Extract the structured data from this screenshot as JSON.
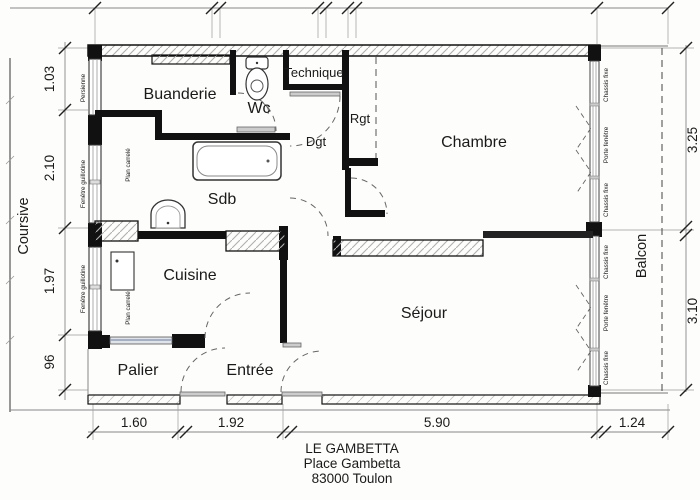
{
  "title_block": {
    "name": "LE GAMBETTA",
    "address": "Place Gambetta",
    "city": "83000 Toulon"
  },
  "rooms": {
    "buanderie": "Buanderie",
    "wc": "Wc",
    "technique": "Technique",
    "rgt": "Rgt",
    "dgt": "Dgt",
    "chambre": "Chambre",
    "sdb": "Sdb",
    "cuisine": "Cuisine",
    "sejour": "Séjour",
    "palier": "Palier",
    "entree": "Entrée"
  },
  "exterior": {
    "coursive": "Coursive",
    "balcon": "Balcon"
  },
  "window_labels": {
    "persienne": "Persienne",
    "guillotine": "Fenêtre guillotine",
    "plan_carrele": "Plan carrelé",
    "chassis_fixe": "Chassis fixe",
    "porte_fenetre": "Porte fenêtre"
  },
  "dimensions": {
    "left": [
      "1.03",
      "2.10",
      "1.97",
      "96"
    ],
    "right": [
      "3.25",
      "3.10"
    ],
    "bottom": [
      "1.60",
      "1.92",
      "5.90",
      "1.24"
    ]
  },
  "colors": {
    "wall": "#111111",
    "hatch": "#b0b0b0",
    "dash": "#666666",
    "radiator": "#93a0b4"
  }
}
